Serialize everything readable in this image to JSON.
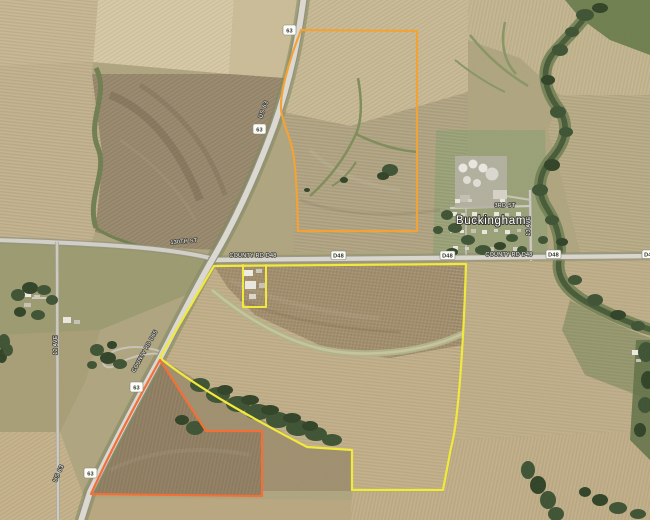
{
  "map": {
    "town": {
      "name": "Buckingham"
    },
    "roads": {
      "us63_label": "US 63",
      "us63_shield": "63",
      "d48_label": "COUNTY RD D48",
      "d48_shield": "D48",
      "d65_label": "COUNTY RD D65",
      "street_130th": "130TH ST",
      "street_3rd": "3RD ST",
      "ave12": "12 AVE",
      "ave13": "13 AVE"
    },
    "parcels": {
      "north": {
        "color": "#F2A338"
      },
      "main": {
        "color": "#F1E93B"
      },
      "southwest": {
        "color": "#F46F35"
      }
    }
  }
}
